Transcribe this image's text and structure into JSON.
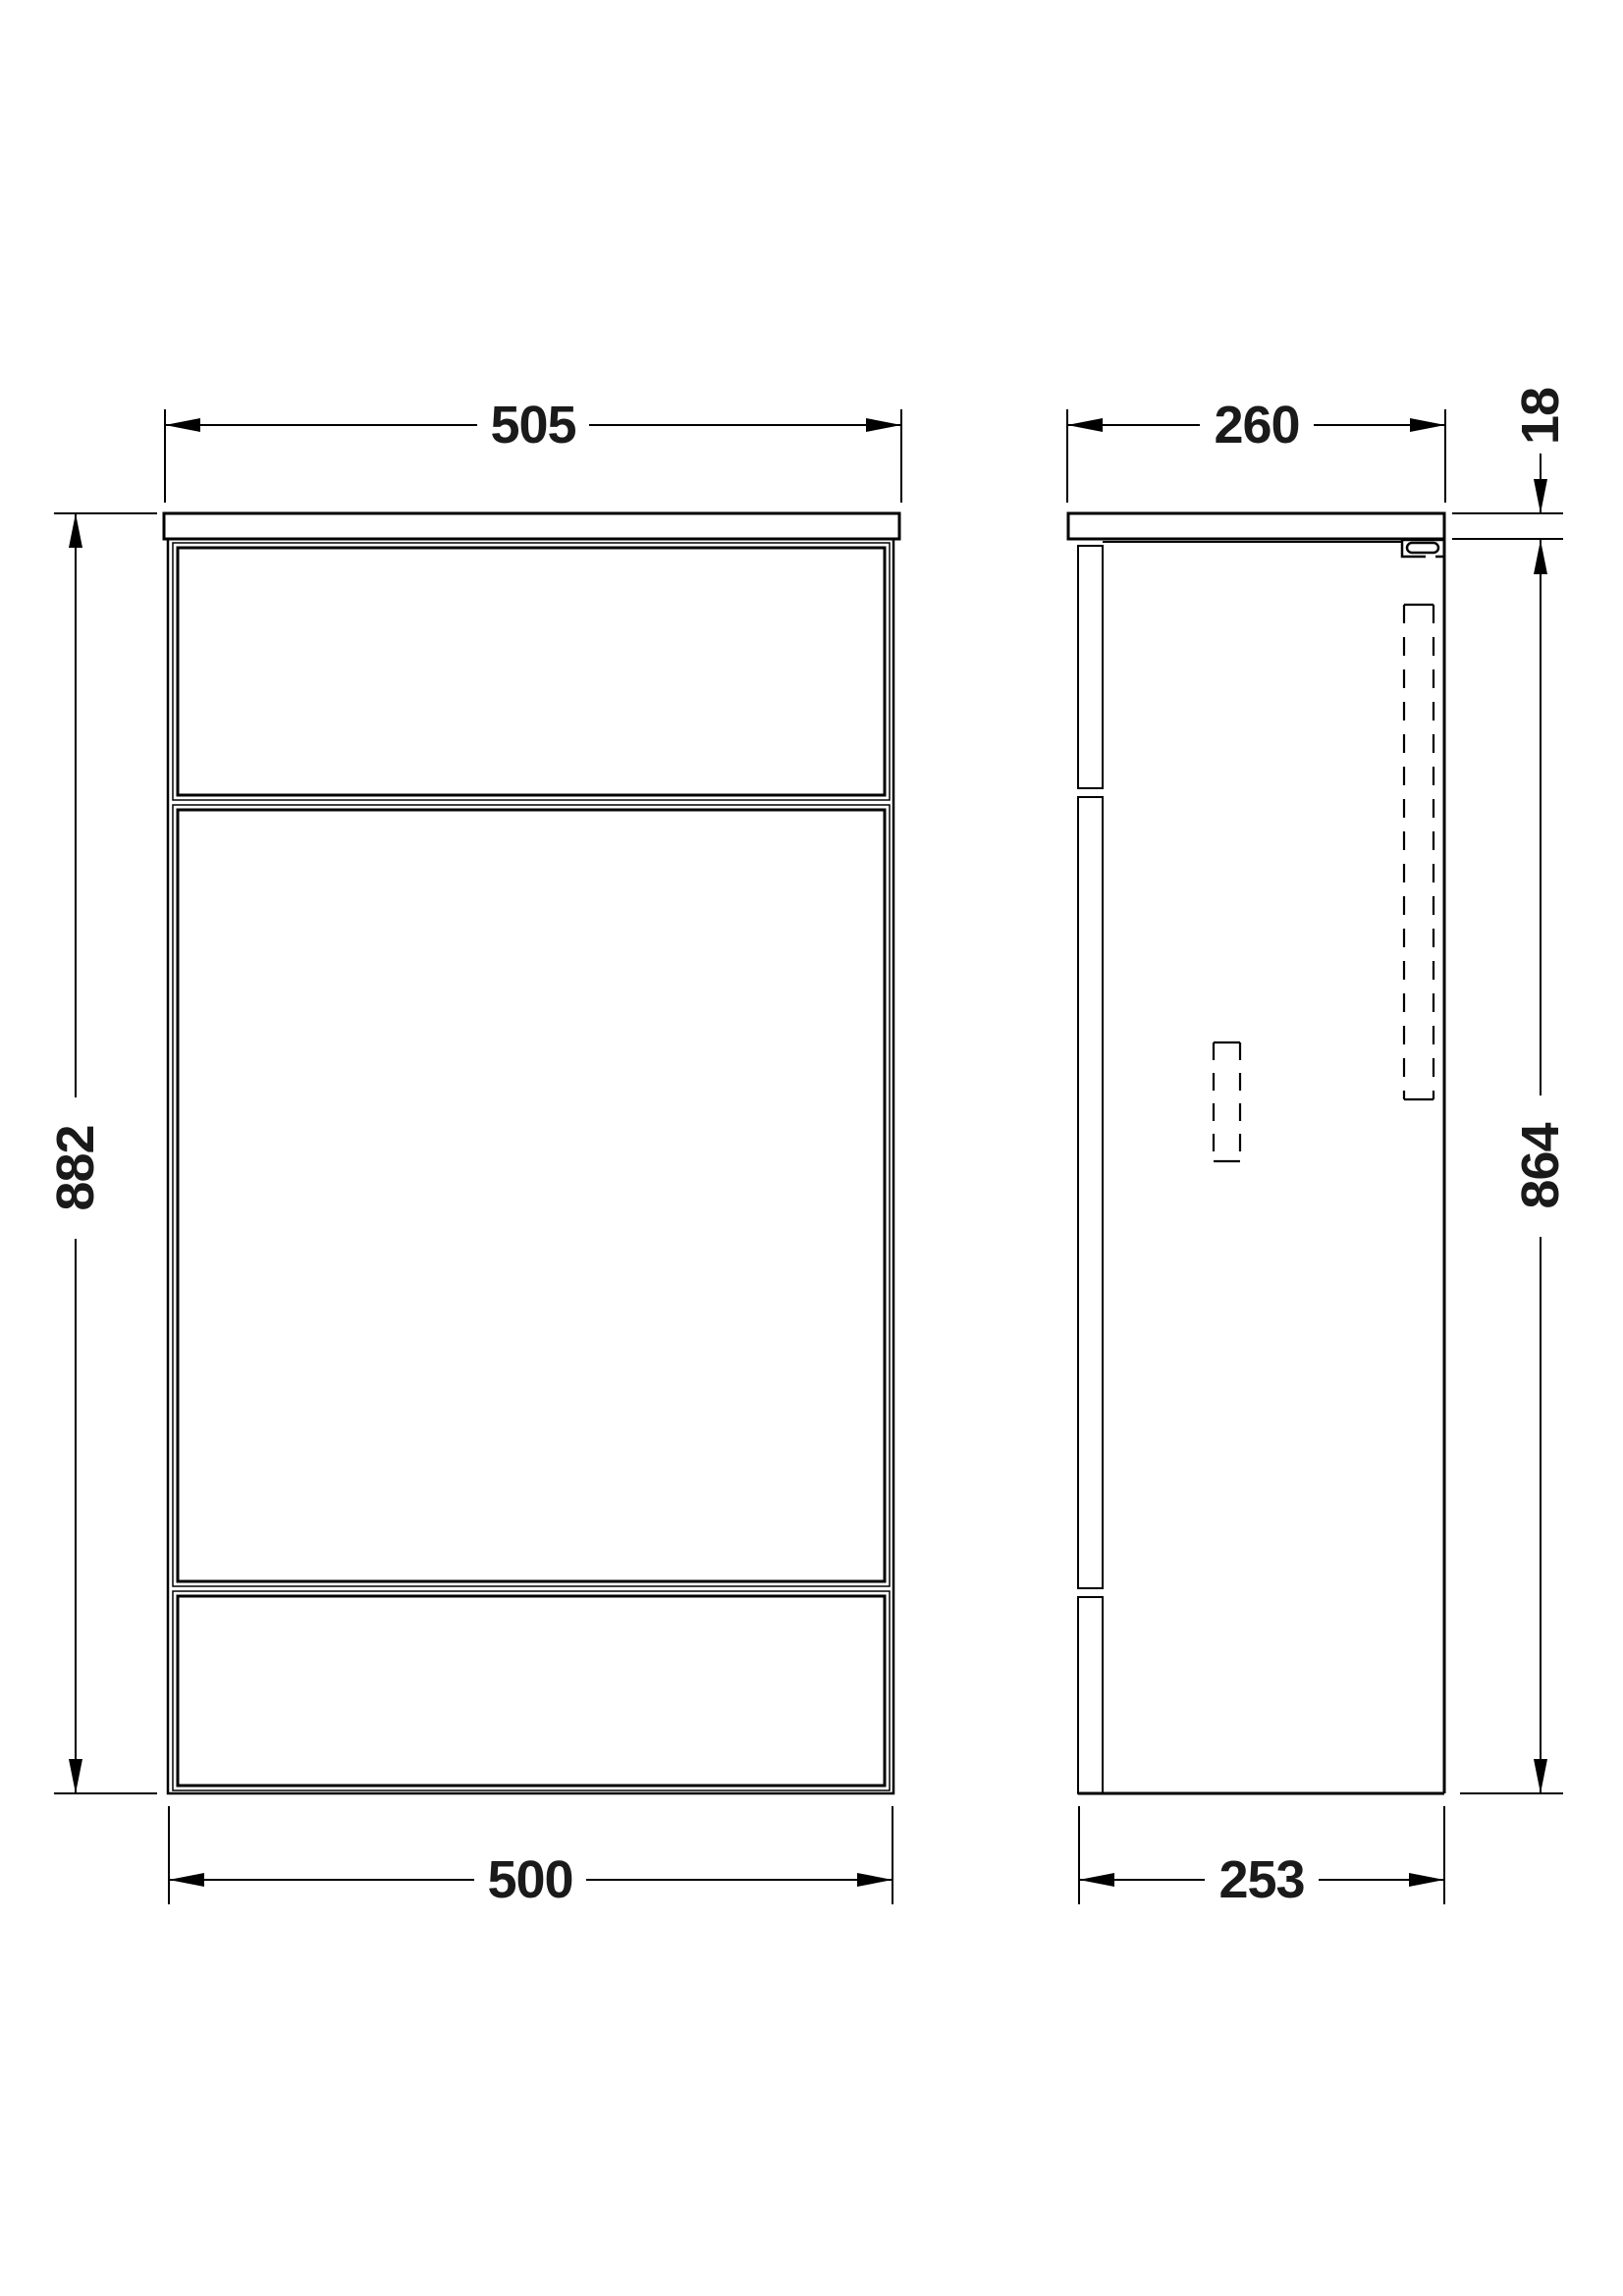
{
  "drawing": {
    "background": "#ffffff",
    "line_color": "#000000",
    "dims": {
      "front_top_width": "505",
      "side_top_depth": "260",
      "worktop_thickness": "18",
      "front_height": "882",
      "side_height": "864",
      "front_bottom_width": "500",
      "side_bottom_depth": "253"
    }
  }
}
